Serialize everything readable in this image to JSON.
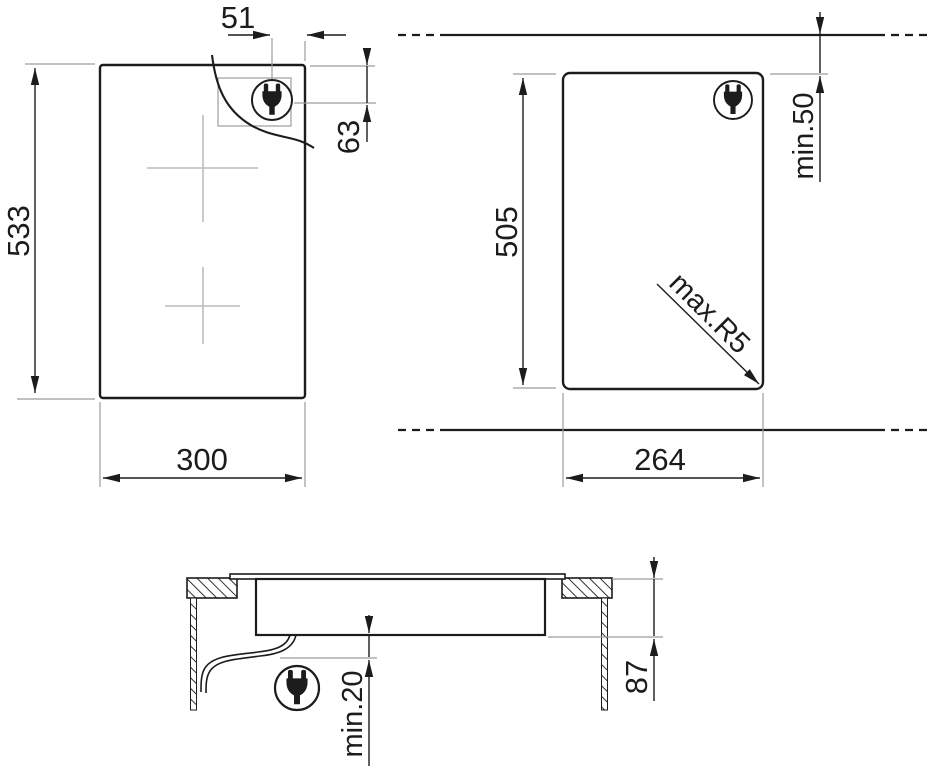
{
  "colors": {
    "line": "#1c1c1c",
    "ext": "#9c9c9c",
    "cross": "#bcbcbc",
    "bg": "#ffffff"
  },
  "dimensions": {
    "top_view": {
      "height": "533",
      "width": "300",
      "plug_offset_x": "51",
      "plug_offset_y": "63"
    },
    "cutout_view": {
      "height": "505",
      "width": "264",
      "wall_clearance": "min.50",
      "corner_radius": "max.R5"
    },
    "section_view": {
      "depth_below_worktop": "87",
      "bottom_clearance": "min.20"
    }
  }
}
